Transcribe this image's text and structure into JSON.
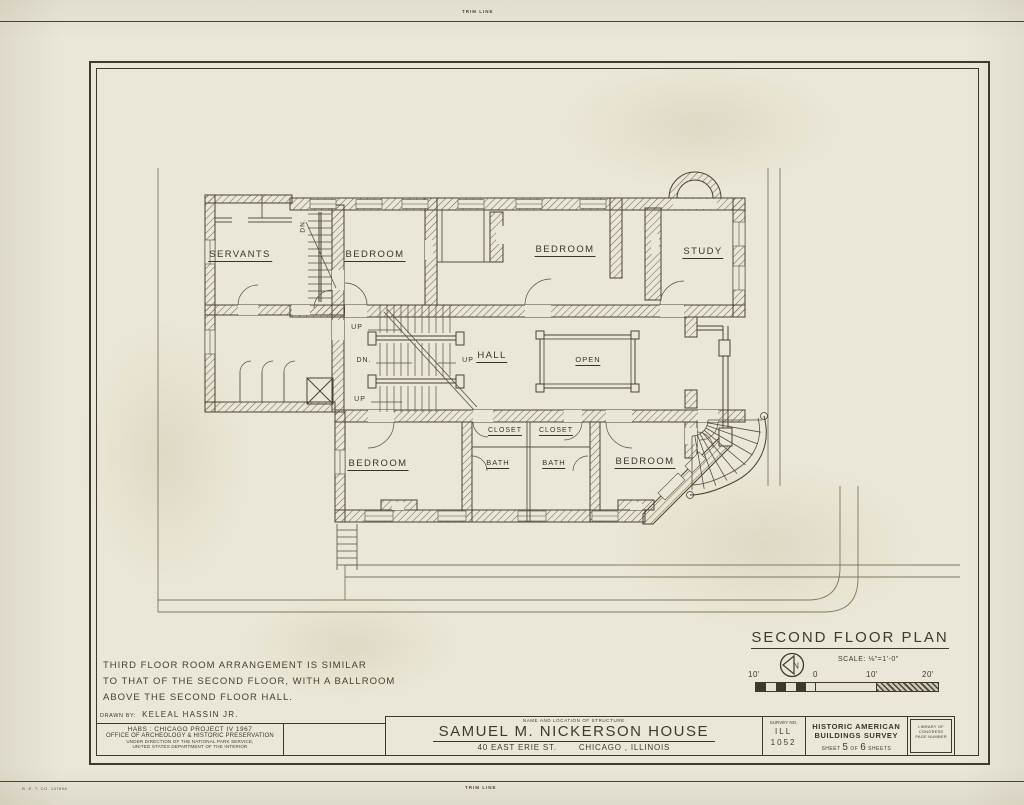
{
  "colors": {
    "paper": "#ebe7d8",
    "ink": "#3e392d"
  },
  "sheet": {
    "trim_top": "TRIM LINE",
    "trim_bottom": "TRIM LINE",
    "print_code": "R. E. T. CO.  147898"
  },
  "plan": {
    "labels": {
      "servants": "SERVANTS",
      "bedroom_nw": "BEDROOM",
      "bedroom_n": "BEDROOM",
      "study": "STUDY",
      "hall": "HALL",
      "open": "OPEN",
      "closet_left": "CLOSET",
      "closet_right": "CLOSET",
      "bath_left": "BATH",
      "bath_right": "BATH",
      "bedroom_sw": "BEDROOM",
      "bedroom_se": "BEDROOM",
      "up_top": "UP",
      "dn_main": "DN.",
      "up_mid": "UP",
      "up_bottom": "UP",
      "dn_service": "DN."
    }
  },
  "notes": {
    "line1": "THIRD FLOOR ROOM ARRANGEMENT IS SIMILAR",
    "line2": "TO THAT OF THE SECOND FLOOR, WITH A BALLROOM",
    "line3": "ABOVE THE SECOND FLOOR HALL."
  },
  "titleblock": {
    "drawn_by_label": "DRAWN BY:",
    "drawn_by_name": "KELEAL HASSIN JR.",
    "agency_line1": "HABS : CHICAGO PROJECT IV 1967",
    "agency_line2": "OFFICE OF ARCHEOLOGY & HISTORIC PRESERVATION",
    "agency_line3": "UNDER DIRECTION OF THE NATIONAL PARK SERVICE,",
    "agency_line4": "UNITED STATES DEPARTMENT OF THE INTERIOR",
    "structure_label": "NAME AND LOCATION OF STRUCTURE",
    "structure_name": "SAMUEL M. NICKERSON HOUSE",
    "structure_address": "40 EAST ERIE ST.",
    "structure_city": "CHICAGO , ILLINOIS",
    "survey_label": "SURVEY NO.",
    "survey_state": "ILL",
    "survey_number": "1052",
    "habs_line1": "HISTORIC AMERICAN",
    "habs_line2": "BUILDINGS SURVEY",
    "sheet_word": "SHEET",
    "sheet_number": "5",
    "of_word": "OF",
    "sheet_total": "6",
    "sheets_word": "SHEETS",
    "library_line1": "LIBRARY OF CONGRESS",
    "library_line2": "PAGE NUMBER"
  },
  "plan_title": {
    "text": "SECOND FLOOR PLAN",
    "scale": "SCALE: ⅛\"=1'-0\"",
    "north_letter": "N"
  },
  "scale_bar": {
    "tick0": "10'",
    "tick1": "0",
    "tick2": "10'",
    "tick3": "20'"
  }
}
